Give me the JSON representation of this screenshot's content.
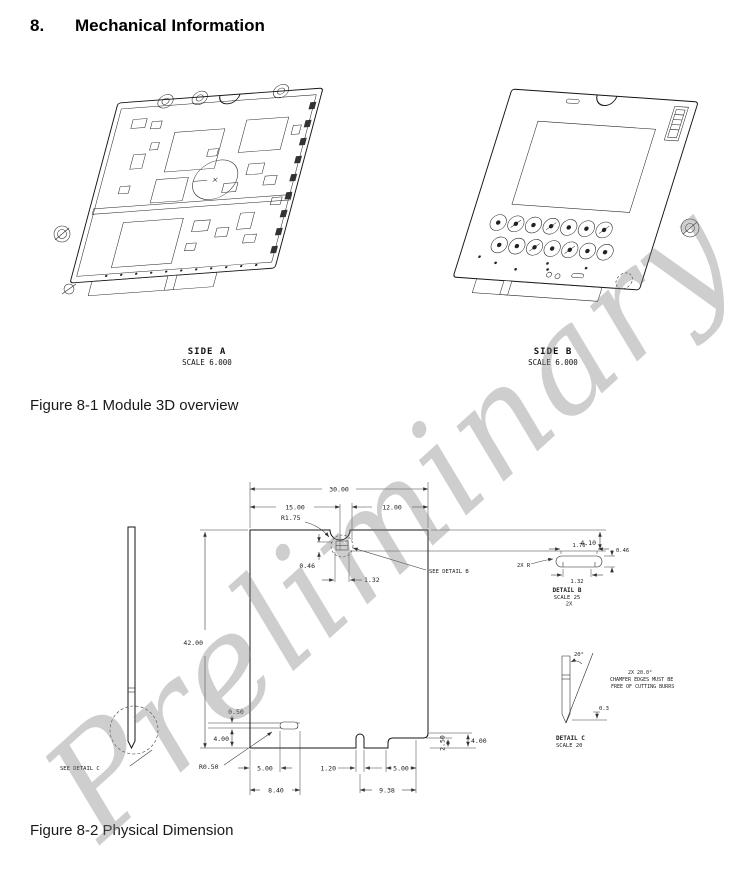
{
  "page": {
    "heading_number": "8.",
    "heading_title": "Mechanical Information",
    "watermark": "Preliminary"
  },
  "figure1": {
    "caption": "Figure 8-1 Module 3D overview",
    "side_a_label": "SIDE A",
    "side_a_scale": "SCALE 6.000",
    "side_b_label": "SIDE B",
    "side_b_scale": "SCALE 6.000"
  },
  "figure2": {
    "caption": "Figure 8-2 Physical Dimension",
    "dims": {
      "total_width": "30.00",
      "left_width": "15.00",
      "right_width": "12.00",
      "notch_radius": "R1.75",
      "right_top_depth": "4.10",
      "tab_offset": "0.46",
      "tab_width": "1.32",
      "see_detail_b": "SEE DETAIL B",
      "total_height": "42.00",
      "left_step": "0.50",
      "left_bottom_height": "4.00",
      "left_radius": "R0.50",
      "left_width_inner": "5.00",
      "left_width_outer": "8.40",
      "key_width": "1.20",
      "right_width_inner": "5.00",
      "right_width_outer": "9.38",
      "right_step_height": "2.50",
      "right_bottom_height": "4.00",
      "see_detail_c": "SEE DETAIL C"
    },
    "detail_b": {
      "label": "DETAIL B",
      "scale": "SCALE 25",
      "count": "2X",
      "width_top": "1.70",
      "height": "0.46",
      "width_bottom": "1.32",
      "radius_note": "2X R"
    },
    "detail_c": {
      "label": "DETAIL C",
      "scale": "SCALE 20",
      "angle": "20°",
      "note1": "2X 20.0°",
      "note2": "CHAMFER EDGES MUST BE",
      "note3": "FREE OF CUTTING BURRS",
      "chamfer": "0.3"
    }
  }
}
